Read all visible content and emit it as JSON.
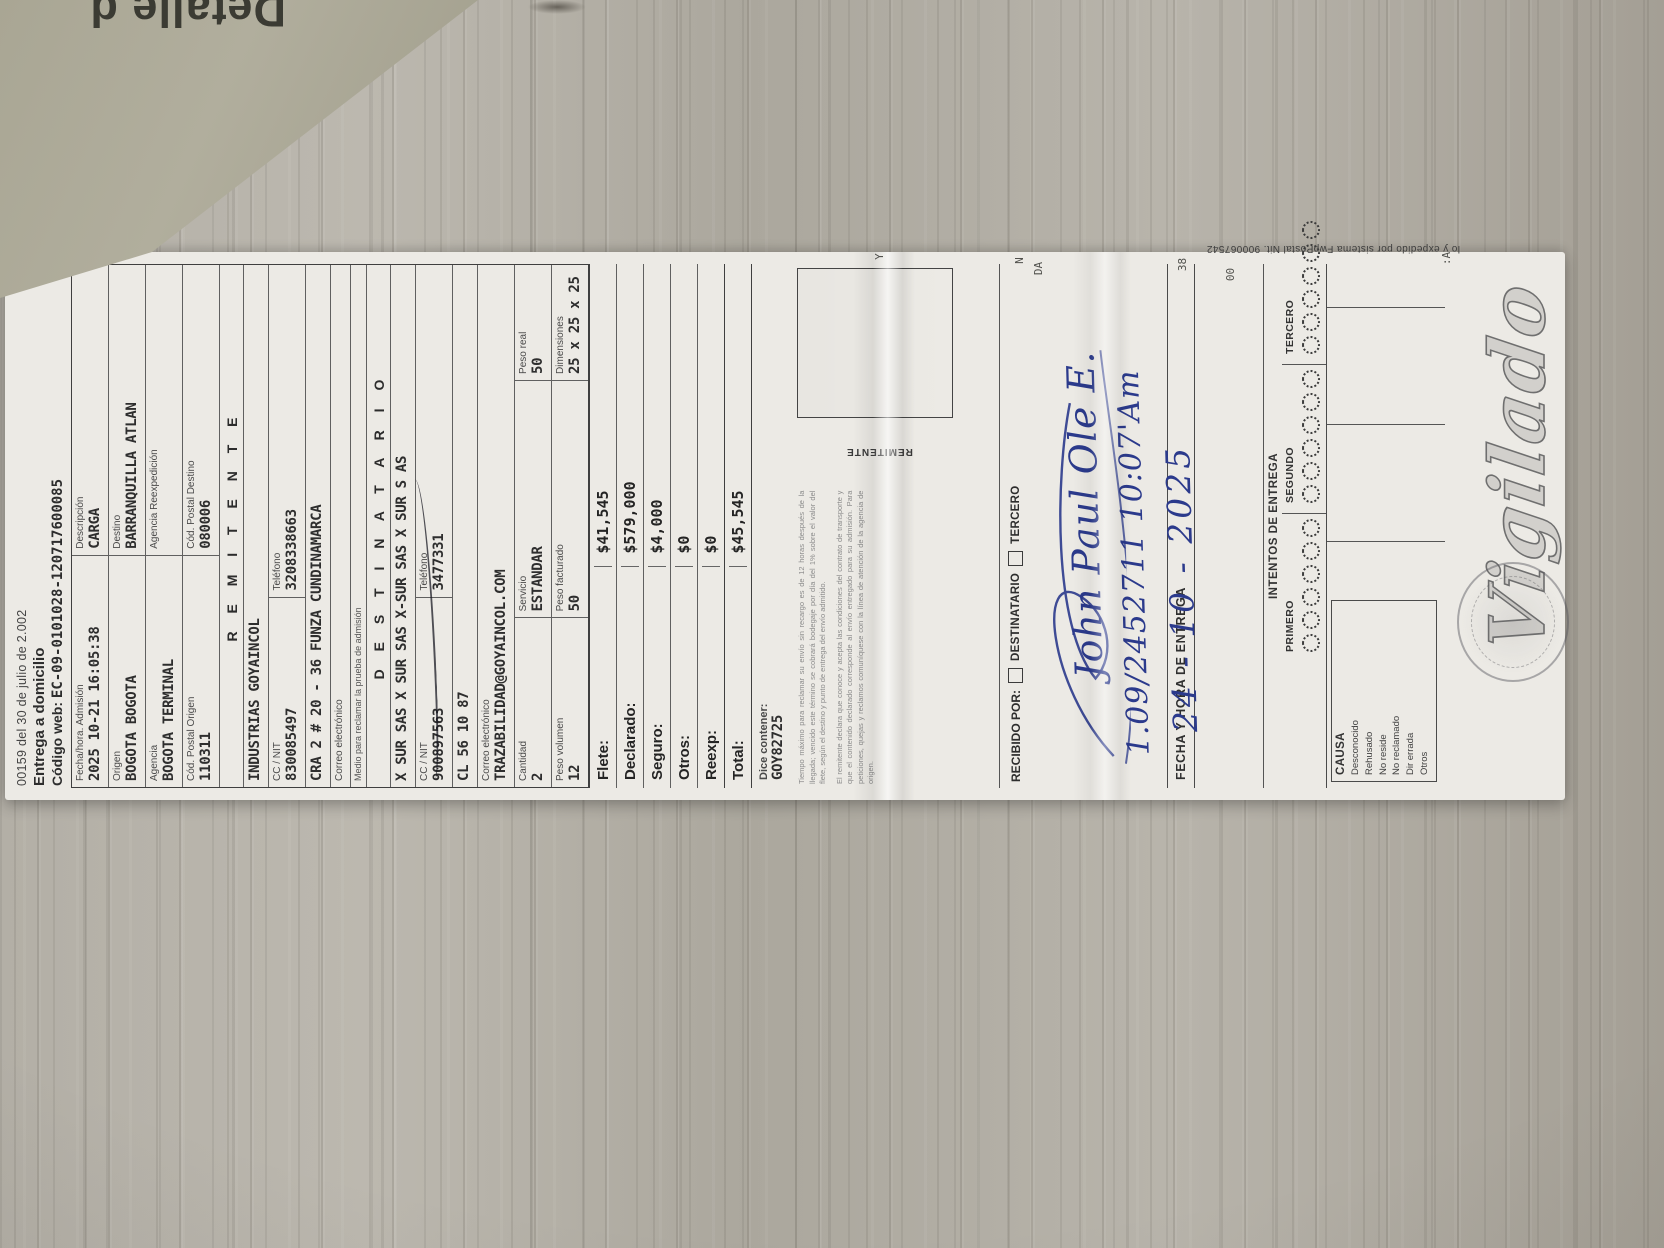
{
  "palette": {
    "ink_blue": "#2b3a8c",
    "paper": "#eceae5",
    "wood": "#b3afa6",
    "kraft": "#a9a694",
    "print": "#383838"
  },
  "kraft": {
    "label": "Detalle d"
  },
  "edge_fragments": [
    "Y",
    "N",
    "DA",
    "38",
    "00",
    ":A"
  ],
  "receipt": {
    "law_line": "00159 del 30 de julio de 2.002",
    "title": "Entrega a domicilio",
    "code_label": "Código web:",
    "code": "EC-09-0101028-120717600085",
    "admission": {
      "label": "Fecha/hora. Admisión",
      "value": "2025 10-21 16:05:38"
    },
    "description": {
      "label": "Descripción",
      "value": "CARGA"
    },
    "origin": {
      "label": "Origen",
      "value": "BOGOTA BOGOTA"
    },
    "destination": {
      "label": "Destino",
      "value": "BARRANQUILLA ATLAN"
    },
    "agency": {
      "label": "Agencia",
      "value": "BOGOTA TERMINAL"
    },
    "agency_reexp": {
      "label": "Agencia Reexpedición",
      "value": ""
    },
    "postal_origin": {
      "label": "Cód. Postal Origen",
      "value": "110311"
    },
    "postal_dest": {
      "label": "Cód. Postal Destino",
      "value": "080006"
    },
    "sender": {
      "header": "R E M I T E N T E",
      "name": "INDUSTRIAS  GOYAINCOL",
      "nit_label": "CC / NIT",
      "nit": "830085497",
      "phone_label": "Teléfono",
      "phone": "3208338663",
      "address": "CRA 2 # 20 - 36 FUNZA CUNDINAMARCA",
      "email_label": "Correo electrónico",
      "email": "",
      "proof_note": "Medio para reclamar la prueba de admisión"
    },
    "recipient": {
      "header": "D E S T I N A T A R I O",
      "name": "X SUR SAS X SUR SAS X-SUR SAS X SUR S AS",
      "nit_label": "CC / NIT",
      "nit": "900897563",
      "phone_label": "Teléfono",
      "phone": "3477331",
      "address": "CL 56 10 87",
      "email_label": "Correo electrónico",
      "email": "TRAZABILIDAD@GOYAINCOL.COM"
    },
    "shipment": {
      "qty_label": "Cantidad",
      "qty": "2",
      "service_label": "Servicio",
      "service": "ESTANDAR",
      "peso_real_label": "Peso real",
      "peso_real": "50",
      "peso_vol_label": "Peso volumen",
      "peso_vol": "12",
      "peso_fact_label": "Peso facturado",
      "peso_fact": "50",
      "dim_label": "Dimensiones",
      "dim": "25 x 25 x 25"
    },
    "charges": [
      {
        "label": "Flete:",
        "value": "$41,545"
      },
      {
        "label": "Declarado:",
        "value": "$579,000"
      },
      {
        "label": "Seguro:",
        "value": "$4,000"
      },
      {
        "label": "Otros:",
        "value": "$0"
      },
      {
        "label": "Reexp:",
        "value": "$0"
      },
      {
        "label": "Total:",
        "value": "$45,545"
      }
    ],
    "contains": {
      "label": "Dice contener:",
      "value": "GOY82725"
    },
    "fine_print_a": "Tiempo máximo para reclamar su envío sin recargo es de 12 horas después de la llegada; vencido este término se cobrará bodegaje por día del 1% sobre el valor del flete, según el destino y punto de entrega del envío admitido.",
    "fine_print_b": "El remitente declara que conoce y acepta las condiciones del contrato de transporte y que el contenido declarado corresponde al envío entregado para su admisión. Para peticiones, quejas y reclamos comuníquese con la línea de atención de la agencia de origen.",
    "sender_box_label": "REMITENTE",
    "received": {
      "label": "RECIBIDO POR:",
      "opt1": "DESTINATARIO",
      "opt2": "TERCERO"
    },
    "handwriting": {
      "signature": "John Paul Ole E.",
      "id_line": "1.09/2452711  10:07'Am",
      "date": "24 - 10 - 2025"
    },
    "delivery": {
      "date_label": "FECHA Y HORA DE ENTREGA",
      "attempts_label": "INTENTOS DE ENTREGA",
      "attempt_cols": [
        "PRIMERO",
        "SEGUNDO",
        "TERCERO"
      ],
      "circles_per_col": 6,
      "causa_label": "CAUSA",
      "causes": [
        "Desconocido",
        "Rehusado",
        "No reside",
        "No reclamado",
        "Dir errada",
        "Otros"
      ]
    },
    "edge_note": "lo y expedido por sistema FwpPostal Nit. 900067542",
    "watermark": "Vigilado"
  }
}
